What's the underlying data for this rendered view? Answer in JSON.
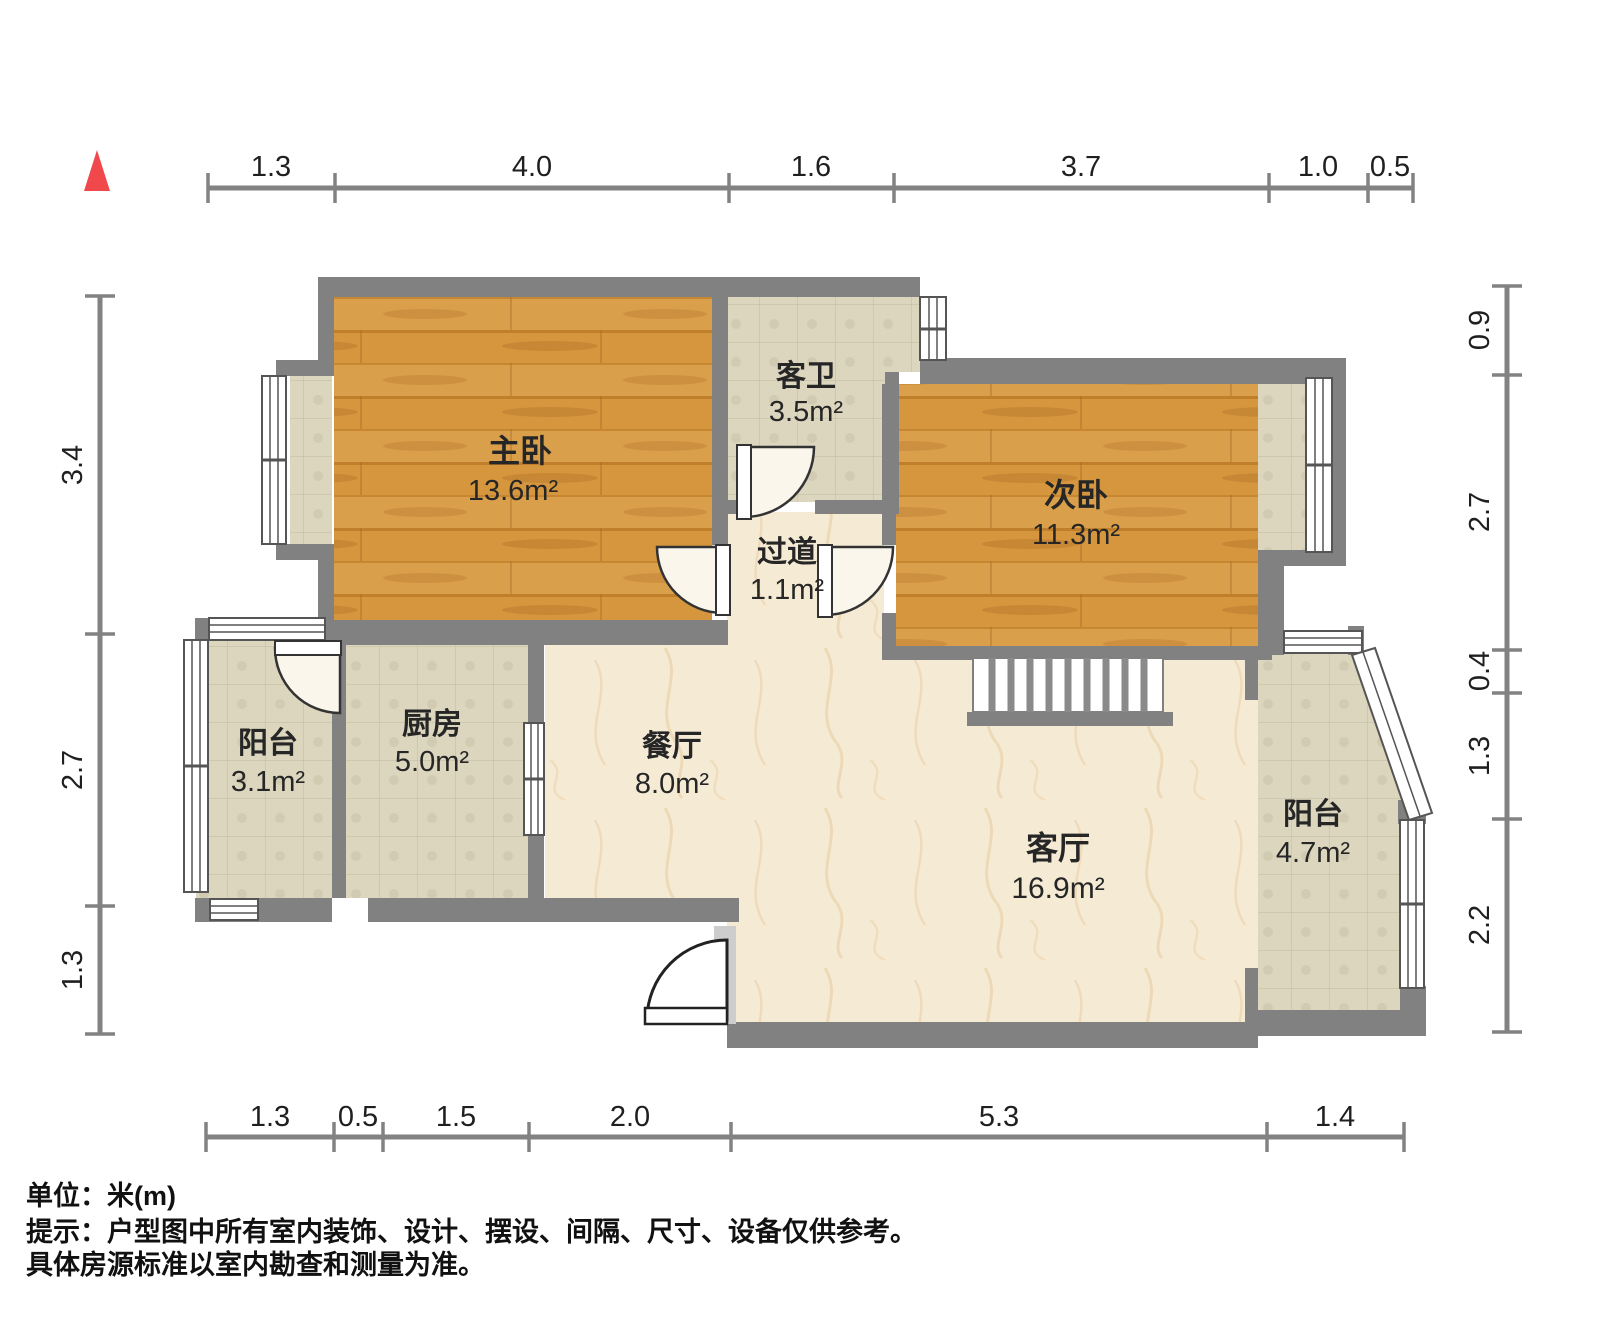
{
  "title": "户型图",
  "compass": {
    "color": "#F0484B",
    "shape": "north-triangle"
  },
  "rooms": {
    "master_bedroom": {
      "name": "主卧",
      "area": "13.6m²",
      "floor": "wood"
    },
    "guest_bathroom": {
      "name": "客卫",
      "area": "3.5m²",
      "floor": "tile"
    },
    "hallway": {
      "name": "过道",
      "area": "1.1m²",
      "floor": "marble"
    },
    "second_bedroom": {
      "name": "次卧",
      "area": "11.3m²",
      "floor": "wood"
    },
    "kitchen": {
      "name": "厨房",
      "area": "5.0m²",
      "floor": "tile"
    },
    "balcony_left": {
      "name": "阳台",
      "area": "3.1m²",
      "floor": "tile"
    },
    "dining_room": {
      "name": "餐厅",
      "area": "8.0m²",
      "floor": "marble"
    },
    "living_room": {
      "name": "客厅",
      "area": "16.9m²",
      "floor": "marble"
    },
    "balcony_right": {
      "name": "阳台",
      "area": "4.7m²",
      "floor": "tile"
    }
  },
  "dimensions": {
    "unit": "m",
    "top": {
      "labels": [
        "1.3",
        "4.0",
        "1.6",
        "3.7",
        "1.0",
        "0.5"
      ]
    },
    "left": {
      "labels": [
        "3.4",
        "2.7",
        "1.3"
      ]
    },
    "right": {
      "labels": [
        "0.9",
        "2.7",
        "0.4",
        "1.3",
        "2.2"
      ]
    },
    "bottom": {
      "labels": [
        "1.3",
        "0.5",
        "1.5",
        "2.0",
        "5.3",
        "1.4"
      ]
    }
  },
  "footer": {
    "unit_note": "单位：米(m)",
    "disclaimer_line1": "提示：户型图中所有室内装饰、设计、摆设、间隔、尺寸、设备仅供参考。",
    "disclaimer_line2": "具体房源标准以室内勘查和测量为准。"
  },
  "colors": {
    "wall": "#818181",
    "wood_floor": "#D5963E",
    "tile_floor": "#DBD6BD",
    "marble_floor": "#F5EBD5",
    "dimension_line": "#828282"
  }
}
